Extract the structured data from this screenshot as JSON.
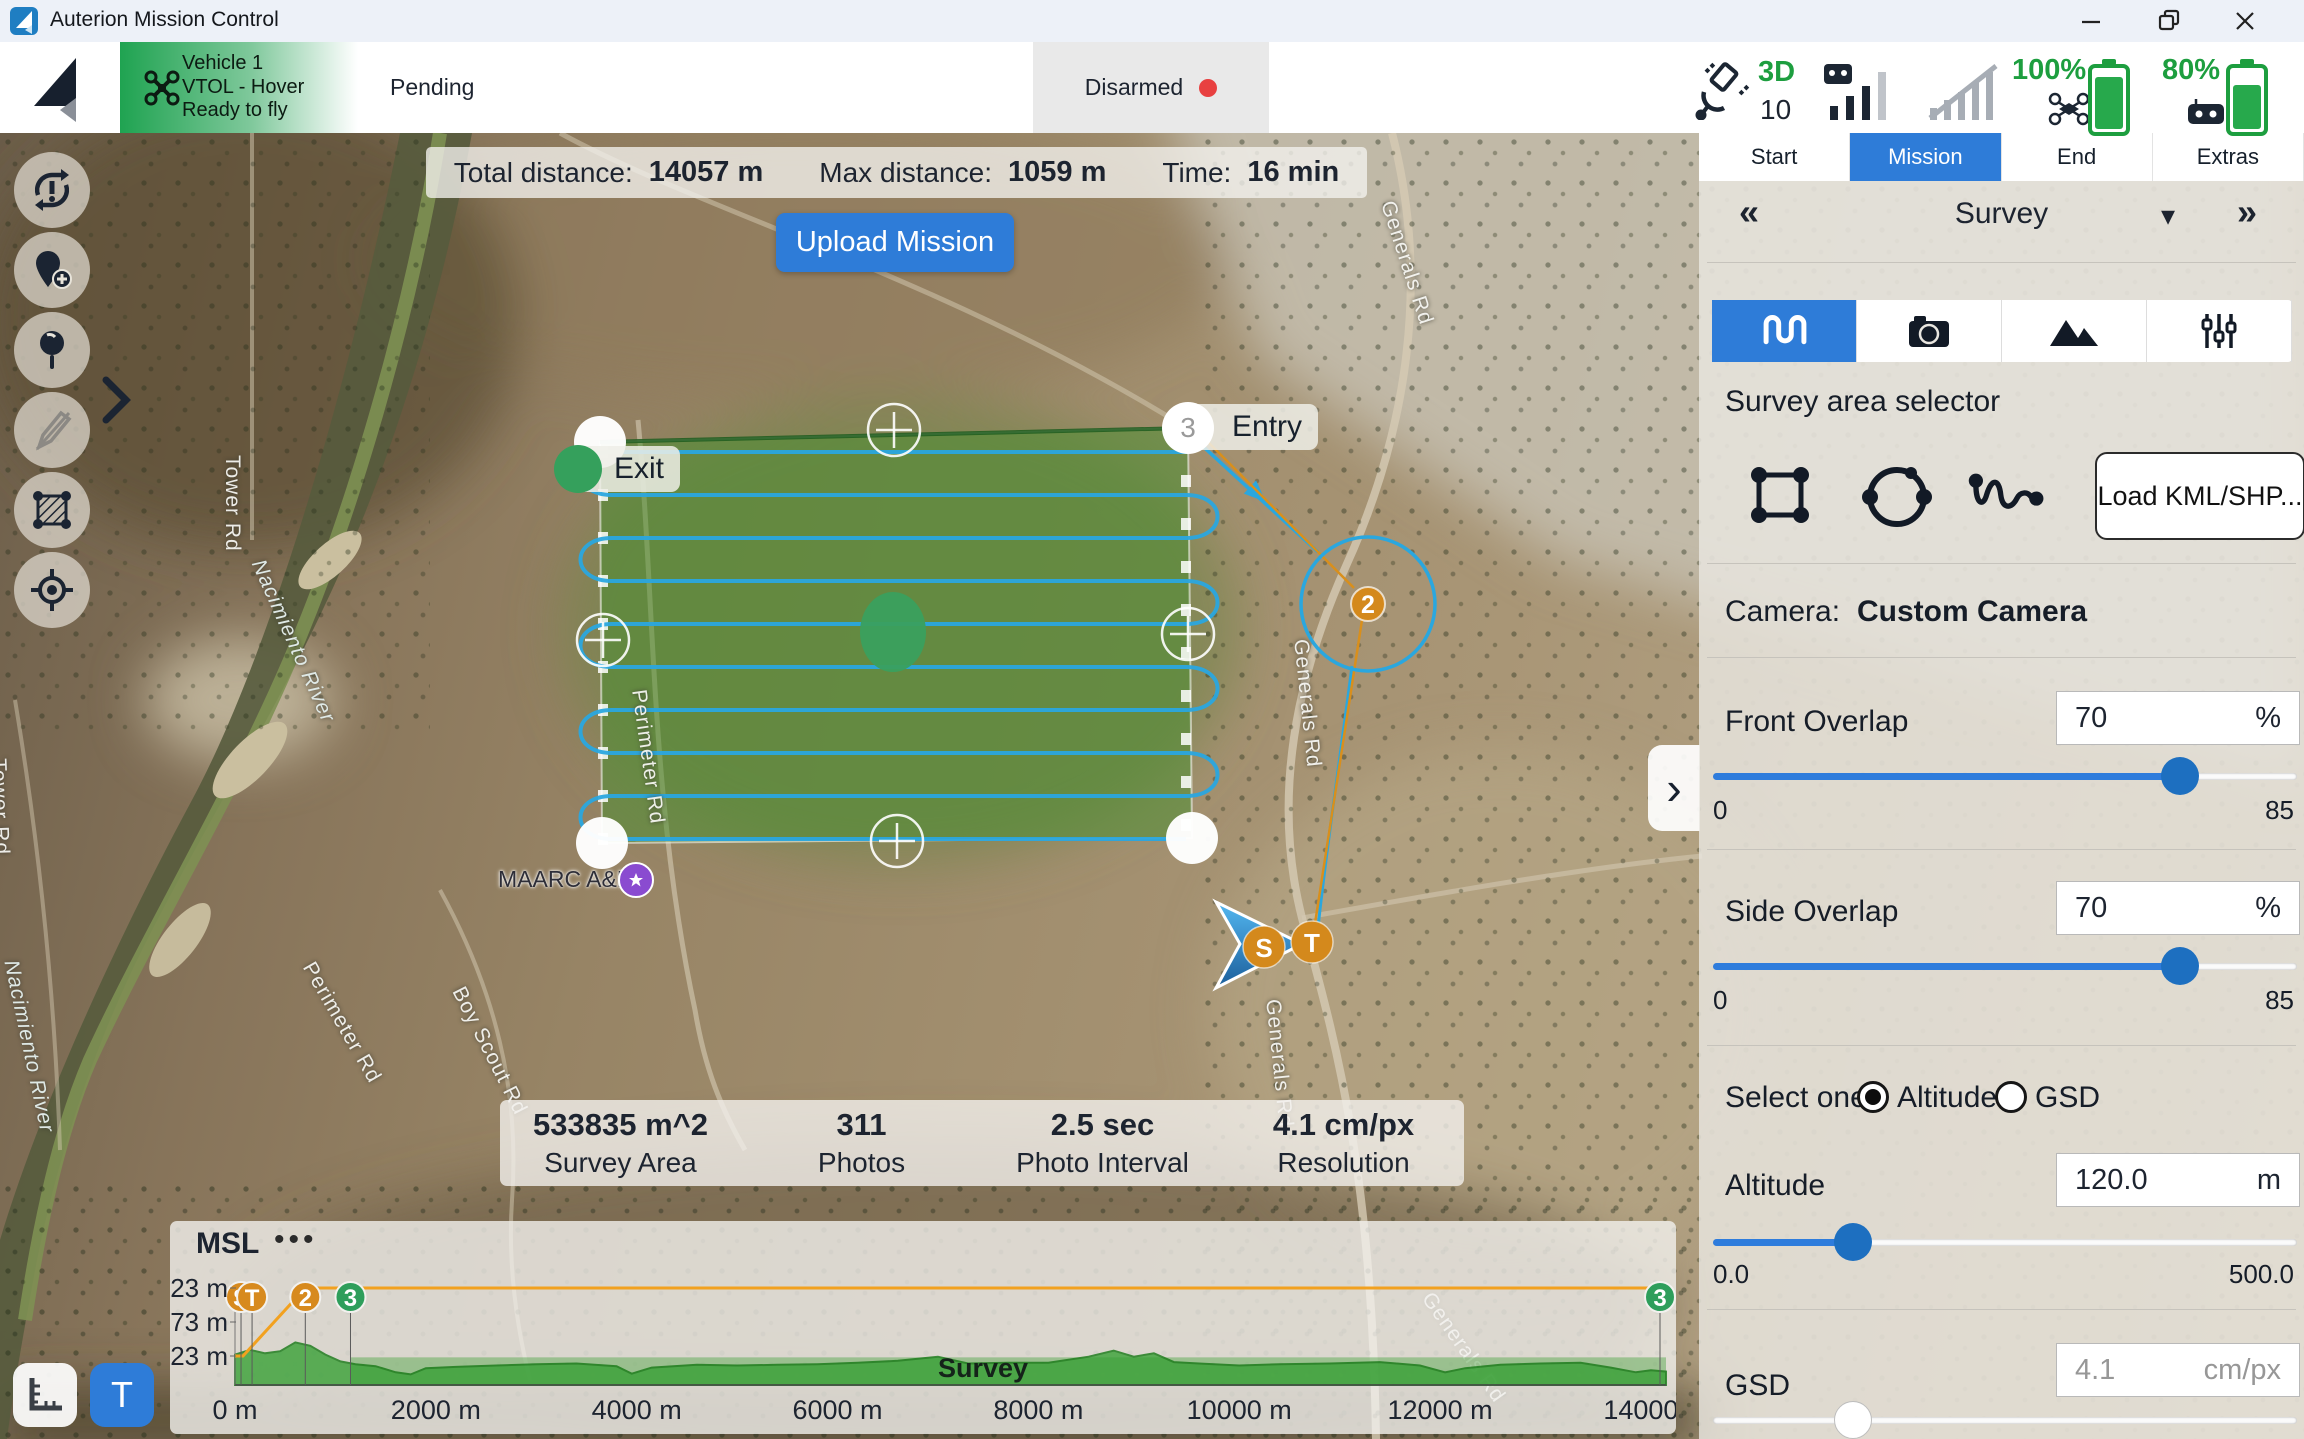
{
  "window": {
    "title": "Auterion Mission Control"
  },
  "toolbar": {
    "vehicle": {
      "name": "Vehicle 1",
      "type": "VTOL - Hover",
      "readiness": "Ready to fly"
    },
    "mission_status": "Pending",
    "arm_status": "Disarmed",
    "gps": {
      "fix_type": "3D",
      "satellite_count": "10"
    },
    "vehicle_battery": "100%",
    "controller_battery": "80%"
  },
  "mission_bar": {
    "total_distance_label": "Total distance:",
    "total_distance_value": "14057 m",
    "max_distance_label": "Max distance:",
    "max_distance_value": "1059 m",
    "time_label": "Time:",
    "time_value": "16 min",
    "upload_label": "Upload Mission"
  },
  "map": {
    "entry_label": "Entry",
    "exit_label": "Exit",
    "corner_waypoint_number": "3",
    "waypoint2_label": "2",
    "start_marker": "S",
    "takeoff_marker": "T",
    "poi_label": "MAARC A&B",
    "roads": {
      "tower_rd_1": "Tower Rd",
      "tower_rd_2": "Tower Rd",
      "nacimiento_river_1": "Nacimiento River",
      "nacimiento_river_2": "Nacimiento River",
      "perimeter_rd_1": "Perimeter Rd",
      "perimeter_rd_2": "Perimeter Rd",
      "boy_scout_rd": "Boy Scout Rd",
      "generals_rd_1": "Generals Rd",
      "generals_rd_2": "Generals Rd",
      "generals_rd_3": "Generals Rd",
      "generals_rd_4": "Generals Rd"
    },
    "stats": [
      {
        "value": "533835 m^2",
        "label": "Survey Area"
      },
      {
        "value": "311",
        "label": "Photos"
      },
      {
        "value": "2.5 sec",
        "label": "Photo Interval"
      },
      {
        "value": "4.1 cm/px",
        "label": "Resolution"
      }
    ]
  },
  "panel": {
    "tabs": [
      {
        "label": "Start"
      },
      {
        "label": "Mission"
      },
      {
        "label": "End"
      },
      {
        "label": "Extras"
      }
    ],
    "active_tab": "Mission",
    "prev_item_glyph": "«",
    "next_item_glyph": "»",
    "selected_item": "Survey",
    "dropdown_glyph": "▾",
    "survey_area_selector_label": "Survey area selector",
    "load_kml_label": "Load KML/SHP...",
    "camera_label": "Camera:",
    "camera_value": "Custom Camera",
    "front_overlap": {
      "label": "Front Overlap",
      "value": "70",
      "unit": "%",
      "min": "0",
      "max": "85"
    },
    "side_overlap": {
      "label": "Side Overlap",
      "value": "70",
      "unit": "%",
      "min": "0",
      "max": "85"
    },
    "select_one_label": "Select one:",
    "altitude_option": "Altitude",
    "gsd_option": "GSD",
    "altitude": {
      "label": "Altitude",
      "value": "120.0",
      "unit": "m",
      "min": "0.0",
      "max": "500.0"
    },
    "gsd": {
      "label": "GSD",
      "value": "4.1",
      "unit": "cm/px"
    },
    "collapse_glyph": "›"
  },
  "left_toolbar": {
    "terrain_button_label": "T"
  },
  "chart": {
    "menu_glyph": "•••"
  },
  "chart_data": {
    "type": "area",
    "title": "MSL",
    "xlabel": "",
    "ylabel": "",
    "x_unit": "m",
    "xlim": [
      0,
      14250
    ],
    "ylim_m": [
      180,
      340
    ],
    "grid": false,
    "x_ticks": [
      "0 m",
      "2000 m",
      "4000 m",
      "6000 m",
      "8000 m",
      "10000 m",
      "12000 m",
      "14000"
    ],
    "x_tick_values_m": [
      0,
      2000,
      4000,
      6000,
      8000,
      10000,
      12000,
      14000
    ],
    "y_ticks": [
      "323 m",
      "273 m",
      "223 m"
    ],
    "y_tick_values_m": [
      323,
      273,
      223
    ],
    "mission_altitude_line": {
      "color": "#f2a11f",
      "points_m": [
        [
          0,
          223
        ],
        [
          80,
          223
        ],
        [
          700,
          323
        ],
        [
          14250,
          323
        ]
      ]
    },
    "terrain_profile_m": [
      [
        0,
        225
      ],
      [
        150,
        232
      ],
      [
        300,
        227
      ],
      [
        450,
        230
      ],
      [
        600,
        243
      ],
      [
        750,
        238
      ],
      [
        900,
        225
      ],
      [
        1050,
        215
      ],
      [
        1200,
        211
      ],
      [
        1400,
        208
      ],
      [
        1600,
        199
      ],
      [
        1750,
        196
      ],
      [
        1900,
        205
      ],
      [
        2200,
        207
      ],
      [
        2600,
        209
      ],
      [
        3000,
        211
      ],
      [
        3400,
        212
      ],
      [
        3800,
        208
      ],
      [
        3950,
        197
      ],
      [
        4150,
        206
      ],
      [
        4600,
        210
      ],
      [
        5000,
        209
      ],
      [
        5400,
        210
      ],
      [
        5800,
        211
      ],
      [
        6200,
        213
      ],
      [
        6600,
        216
      ],
      [
        7000,
        222
      ],
      [
        7300,
        212
      ],
      [
        7700,
        213
      ],
      [
        8100,
        213
      ],
      [
        8500,
        222
      ],
      [
        8750,
        231
      ],
      [
        8950,
        222
      ],
      [
        9150,
        227
      ],
      [
        9350,
        214
      ],
      [
        9600,
        212
      ],
      [
        10000,
        209
      ],
      [
        10400,
        211
      ],
      [
        10900,
        212
      ],
      [
        11400,
        214
      ],
      [
        11800,
        209
      ],
      [
        12050,
        199
      ],
      [
        12250,
        205
      ],
      [
        12600,
        210
      ],
      [
        13000,
        212
      ],
      [
        13400,
        213
      ],
      [
        13700,
        206
      ],
      [
        13950,
        199
      ],
      [
        14100,
        202
      ],
      [
        14250,
        200
      ]
    ],
    "survey_band": {
      "label": "Survey",
      "x_start_m": 1150,
      "x_end_m": 14250,
      "top_m": 221
    },
    "markers": [
      {
        "label": "S",
        "x_m": 60,
        "color": "#d78a1e"
      },
      {
        "label": "T",
        "x_m": 170,
        "color": "#d78a1e"
      },
      {
        "label": "2",
        "x_m": 700,
        "color": "#d78a1e"
      },
      {
        "label": "3",
        "x_m": 1150,
        "color": "#2e9e5b"
      },
      {
        "label": "3",
        "x_m": 14250,
        "color": "#2e9e5b"
      }
    ]
  }
}
